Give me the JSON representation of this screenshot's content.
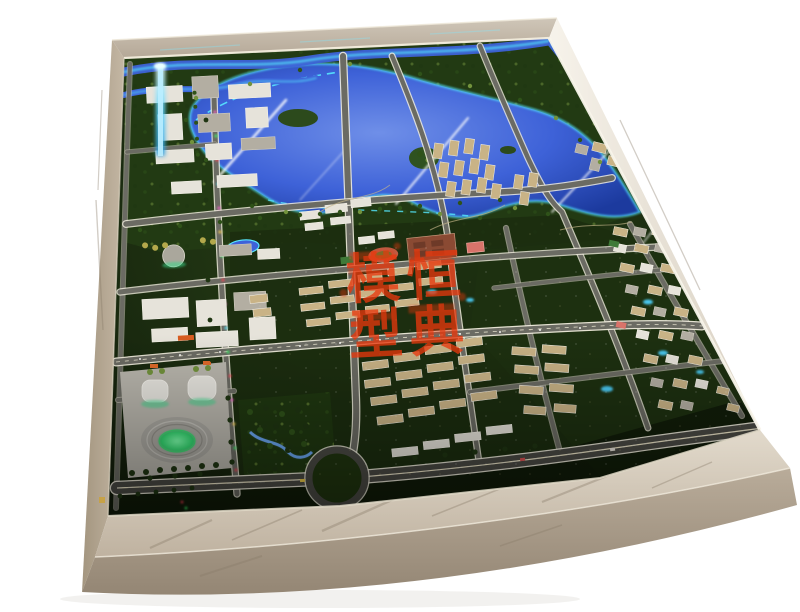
{
  "scene": {
    "type": "photograph",
    "subject": "Illuminated architectural city-planning scale model displayed on a marble-framed table, photographed at an angle on a white background",
    "background_color": "#ffffff"
  },
  "watermark": {
    "characters": [
      "模",
      "恒",
      "型",
      "典"
    ],
    "color": "#e8380d"
  },
  "landmarks": [
    "lake with cyan LED shoreline",
    "glowing rivers",
    "road grid with lit edges",
    "highway interchange ring",
    "oval stadium with glowing green field",
    "arena halls",
    "white commercial campus",
    "glowing blue tower",
    "beige residential tower clusters",
    "red running track",
    "marble display table frame"
  ],
  "palette": {
    "marbleLight": "#d8cfc1",
    "marbleMid": "#bcaf9e",
    "marbleDark": "#998b79",
    "marbleStreak": "#8a7c6a",
    "trimLight": "#f4eede",
    "baseDeep": "#101a09",
    "baseGreen": "#263f15",
    "parkGreen": "#223a13",
    "lakeDeep": "#1c3a9e",
    "lakeBlue": "#3e62d8",
    "lakeLight": "#6f8fe8",
    "glowCyan": "#56e8ff",
    "roadGray": "#6b6b63",
    "roadDark": "#4a4a44",
    "roadCasing": "#f0ecdd",
    "roadCasingMinor": "#b9b6a9",
    "buildingWhite": "#e6e3da",
    "buildingBeige": "#c9b386",
    "buildingGray": "#b3aea2",
    "roofLight": "#f4f1e8",
    "stadiumGray": "#a9a7a0",
    "fieldGreen": "#2fe06a",
    "trackRed": "#c05a41",
    "courtPink": "#d9736a",
    "schoolRed": "#8a4a33",
    "treeDark": "#1f3512",
    "treeGreen": "#2f5219",
    "treeLight": "#72923c",
    "treeYellow": "#b3a84b",
    "ledRed": "#ff4155",
    "ledGreen": "#3dff6e",
    "ledPink": "#ff5fd2",
    "ledYellow": "#ffd34f",
    "beamBlue": "#5fd4ff",
    "stampRed": "#e8380d",
    "goldTag": "#c9a23f",
    "plateBrown": "#8a5a32"
  }
}
